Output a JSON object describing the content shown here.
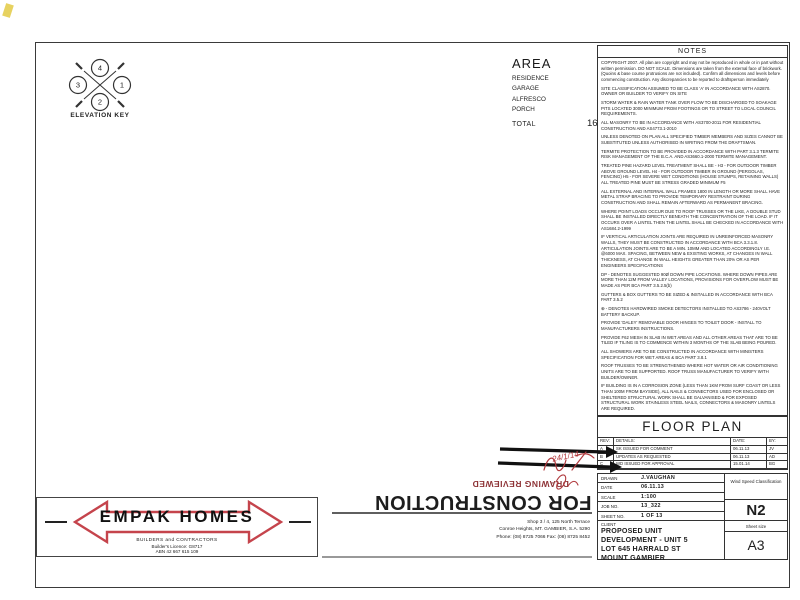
{
  "palette": {
    "ink": "#1f1f1f",
    "wall": "#161616",
    "red_logo": "#c5444c",
    "red_stamp": "#8e3437",
    "tile": "#c9c9c9"
  },
  "elevation_key": {
    "label": "ELEVATION KEY",
    "top": "4",
    "left": "3",
    "right": "1",
    "bottom": "2"
  },
  "area_table": {
    "title": "AREA",
    "rows": [
      [
        "RESIDENCE",
        "130.46"
      ],
      [
        "GARAGE",
        "25.20"
      ],
      [
        "ALFRESCO",
        "9.32"
      ],
      [
        "PORCH",
        "1.39"
      ]
    ],
    "total_label": "TOTAL",
    "total_value": "166.37"
  },
  "notes": {
    "title": "NOTES",
    "paragraphs": [
      "COPYRIGHT 2007. All plan are copyright and may not be reproduced in whole or in part without written permission. DO NOT SCALE. Dimensions are taken from the external face of brickwork. (Quoins & base course protrusions are not included). Confirm all dimensions and levels before commencing construction. Any discrepancies to be reported to draftsperson immediately",
      "SITE CLASSIFICATION ASSUMED TO BE CLASS 'A' IN ACCORDANCE WITH AS2870. OWNER OR BUILDER TO VERIFY ON SITE",
      "STORM WATER & RAIN WATER TANK OVER FLOW TO BE DISCHARGED TO SOAKAGE PITS LOCATED 3000 MINIMUM FROM FOOTINGS OR TO STREET TO LOCAL COUNCIL REQUIREMENTS.",
      "ALL MASONRY TO BE IN ACCORDANCE WITH AS3700-2011 FOR RESIDENTIAL CONSTRUCTION AND AS4773.1-2010",
      "UNLESS DENOTED ON PLAN ALL SPECIFIED TIMBER MEMBERS AND SIZES CANNOT BE SUBSTITUTED UNLESS AUTHORISED IN WRITING FROM THE DRAFTSMAN.",
      "TERMITE PROTECTION TO BE PROVIDED IN ACCORDANCE WITH PART 3.1.3 TERMITE RISK MANAGEMENT OF THE B.C.A. AND AS3660.1-2000 TERMITE MANAGEMENT.",
      "TREATED PINE HAZARD LEVEL TREATMENT SHALL BE -  H3 - FOR OUTDOOR TIMBER ABOVE GROUND LEVEL  H4 - FOR OUTDOOR TIMBER IN GROUND (PERGOLAS, FENCING)  H5 - FOR SEVERE WET CONDITIONS (HOUSE STUMPS, RETAINING WALLS)  ALL TREATED PINE MUST BE STRESS GRADED MINIMUM F5",
      "ALL EXTERNAL AND INTERNAL WALL FRAMES 1800 IN LENGTH OR MORE SHALL HAVE METAL STRAP BRACING TO PROVIDE TEMPORARY RESTRAINT DURING CONSTRUCTION AND SHALL REMAIN AFTERWARD AS PERMANENT BRACING.",
      "WHERE POINT LOADS OCCUR DUE TO ROOF TRUSSES OR THE LIKE, A DOUBLE STUD SHALL BE INSTALLED DIRECTLY BENEATH THE CONCENTRATION OF THE LOAD. IF IT OCCURS OVER A LINTEL THEN THE LINTEL SHALL BE CHECKED IN ACCORDANCE WITH AS1684.2-1999",
      "IF VERTICAL ARTICULATION JOINTS ARE REQUIRED IN UNREINFORCED MASONRY WALLS, THEY MUST BE CONSTRUCTED IN ACCORDANCE WITH BCA 3.3.1.8. ARTICULATION JOINTS ARE TO BE A MIN. 10MM AND LOCATED ACCORDINGLY I.E. @6000 MAX. SPACING, BETWEEN NEW & EXISTING WORKS, AT CHANGES IN WALL THICKNESS, AT CHANGE IN WALL HEIGHTS GREATER THAN 20% OR AS PER ENGINEERS SPECIFICATIONS",
      "DP - DENOTES SUGGESTED 90Ø DOWN PIPE LOCATIONS. WHERE DOWN PIPES ARE MORE THAN 12M FROM VALLEY LOCATIONS, PROVISIONS FOR OVERFLOW MUST BE MADE AS PER BCA PART 3.5.2.5(b)",
      "GUTTERS & BOX GUTTERS TO BE SIZED & INSTALLED IN ACCORDANCE WITH BCA PART 3.5.2",
      "⊕ - DENOTES HARDWIRED SMOKE DETECTORS INSTALLED TO AS3786 - 240VOLT BATTERY BACKUP.",
      "PROVIDE 'DALEY' REMOVABLE DOOR HINGES TO TOILET DOOR - INSTALL TO MANUFACTURERS INSTRUCTIONS.",
      "PROVIDE F62 MESH IN SLAB IN WET AREAS AND ALL OTHER AREAS THAT ARE TO BE TILED IF TILING IS TO COMMENCE WITHIN 3 MONTHS OF THE SLAB BEING POURED.",
      "ALL SHOWERS ARE TO BE CONSTRUCTED IN ACCORDANCE WITH MINISTERS SPECIFICATION FOR WET AREAS & BCA PART 3.8.1",
      "ROOF TRUSSES TO BE STRENGTHENED WHERE HOT WATER OR AIR CONDITIONING UNITS ARE TO BE SUPPORTED. ROOF TRUSS MANUFACTURER TO VERIFY WITH BUILDER/OWNER.",
      "IF BUILDING IS IN A CORROSION ZONE (LESS THAN 1KM FROM SURF COAST OR LESS THAN 100M FROM BAYSIDE), ALL NAILS & CONNECTORS USED FOR ENCLOSED OR SHELTERED STRUCTURAL WORK SHALL BE GALVANISED & FOR EXPOSED STRUCTURAL WORK STAINLESS STEEL NAILS, CONNECTORS & MASONRY LINTELS ARE REQUIRED.",
      "DG - DENOTES WINDOWS & OR DOORS THAT ARE REQUIRED TO BE DOUBLE GLAZED (OR SIMILAR SYSTEM WITH EQUIVALENT VALUES OF U-VALUE 3.73 & SHGC 0.66) TO COMPLY WITH 6 STAR 'FIRST RATE' ENERGY REPORT"
    ]
  },
  "floor_plan_title": "FLOOR PLAN",
  "revision_table": {
    "headers": [
      "REV:",
      "DETAILS:",
      "DATE:",
      "BY:"
    ],
    "rows": [
      [
        "A",
        "SK ISSUED FOR COMMENT",
        "06.11.13",
        "JV"
      ],
      [
        "B",
        "UPDATES AS REQUESTED",
        "06.11.13",
        "AD"
      ],
      [
        "C",
        "WD ISSUED FOR APPROVAL",
        "15.01.14",
        "BG"
      ],
      [
        "",
        "",
        "",
        ""
      ]
    ]
  },
  "title_block": {
    "drawn_label": "DRAWN",
    "drawn": "J.VAUGHAN",
    "date_label": "DATE",
    "date": "06.11.13",
    "scale_label": "SCALE",
    "scale": "1:100",
    "job_label": "JOB NO.",
    "job": "13_322",
    "sheet_label": "SHEET NO.",
    "sheet": "1    OF    13",
    "wind_label": "Wind Speed Classification",
    "wind": "N2",
    "client_label": "CLIENT",
    "client_lines": [
      "PROPOSED UNIT",
      "DEVELOPMENT - UNIT 5",
      "LOT 645 HARRALD ST",
      "MOUNT GAMBIER"
    ],
    "sheet_size_label": "Sheet size",
    "sheet_size": "A3"
  },
  "logo": {
    "name": "EMPAK  HOMES",
    "sub1": "BUILDERS and CONTRACTORS",
    "sub2": "Builder's Licence:  G8717",
    "sub3": "ABN 42 667 615 109"
  },
  "address_lines": [
    "Shop 3 / 4, 125 North Terrace",
    "Conroe Heights, MT. GAMBIER, S.A. 5290",
    "Phone: (08) 8725 7066    Fax: (08) 8725 8452"
  ],
  "stamps": {
    "construction": "FOR CONSTRUCTION",
    "reviewed": "DRAWING REVIEWED",
    "signature_date": "24/1/14"
  },
  "plan": {
    "eaves": {
      "x": 160,
      "y": 178,
      "w": 380,
      "h": 270
    },
    "rooms": [
      {
        "name": "ALFRESCO",
        "x": 233,
        "y": 192,
        "w": 107,
        "h": 64,
        "style": "dashed",
        "lx": 287,
        "ly": 218,
        "fs": 8,
        "diag": "d1"
      },
      {
        "name": "LOUNGE",
        "x": 378,
        "y": 192,
        "w": 86,
        "h": 64,
        "style": "wall",
        "lx": 421,
        "ly": 214,
        "fs": 8,
        "diag": "d1"
      },
      {
        "name": "MEALS",
        "x": 190,
        "y": 256,
        "w": 140,
        "h": 78,
        "style": "wall",
        "tiled": true,
        "lx": 256,
        "ly": 290,
        "fs": 9
      },
      {
        "name": "FAMILY",
        "x": 330,
        "y": 256,
        "w": 170,
        "h": 84,
        "style": "wall",
        "lx": 424,
        "ly": 304,
        "fs": 9.5,
        "sub": "FFL 53.650",
        "diag": "x"
      },
      {
        "name": "KITCHEN",
        "x": 205,
        "y": 334,
        "w": 76,
        "h": 46,
        "style": "wall",
        "tiled": true,
        "lx": 240,
        "ly": 361,
        "fs": 7
      },
      {
        "name": "BED 2",
        "x": 107,
        "y": 262,
        "w": 100,
        "h": 98,
        "style": "wall",
        "lx": 150,
        "ly": 313,
        "fs": 8
      },
      {
        "name": "BED 3",
        "x": 107,
        "y": 360,
        "w": 125,
        "h": 68,
        "style": "wall",
        "lx": 162,
        "ly": 395,
        "fs": 8,
        "diag": "d1"
      },
      {
        "name": "L'DRY",
        "x": 234,
        "y": 360,
        "w": 46,
        "h": 68,
        "style": "wall",
        "tiled": true,
        "lx": 258,
        "ly": 392,
        "fs": 6.5
      },
      {
        "name": "WC",
        "x": 282,
        "y": 388,
        "w": 26,
        "h": 40,
        "style": "wall",
        "tiled": true,
        "lx": 295,
        "ly": 402,
        "fs": 5
      },
      {
        "name": "BATH",
        "x": 310,
        "y": 360,
        "w": 54,
        "h": 68,
        "style": "wall",
        "tiled": true,
        "lx": 337,
        "ly": 390,
        "fs": 7.5
      },
      {
        "name": "BED 1",
        "x": 330,
        "y": 340,
        "w": 82,
        "h": 88,
        "style": "wall",
        "lx": 368,
        "ly": 386,
        "fs": 8
      },
      {
        "name": "ENTRY",
        "x": 396,
        "y": 310,
        "w": 48,
        "h": 34,
        "style": "wall",
        "lx": 420,
        "ly": 328,
        "fs": 6.5
      },
      {
        "name": "GARAGE",
        "x": 420,
        "y": 314,
        "w": 85,
        "h": 114,
        "style": "wall",
        "lx": 461,
        "ly": 347,
        "fs": 10,
        "diag": "x"
      }
    ],
    "fixtures": [
      {
        "type": "rect",
        "x": 296,
        "y": 292,
        "w": 36,
        "h": 76
      },
      {
        "type": "circle",
        "cx": 306,
        "cy": 318,
        "r": 2.2
      },
      {
        "type": "circle",
        "cx": 316,
        "cy": 318,
        "r": 2.2
      },
      {
        "type": "circle",
        "cx": 306,
        "cy": 330,
        "r": 2.2
      },
      {
        "type": "circle",
        "cx": 316,
        "cy": 330,
        "r": 2.2
      },
      {
        "type": "rect",
        "x": 212,
        "y": 340,
        "w": 16,
        "h": 9
      },
      {
        "type": "rect",
        "x": 282,
        "y": 334,
        "w": 22,
        "h": 24
      },
      {
        "type": "rrect",
        "x": 316,
        "y": 400,
        "w": 44,
        "h": 22
      },
      {
        "type": "ellipse",
        "cx": 295,
        "cy": 404,
        "rx": 4,
        "ry": 6
      },
      {
        "type": "rect",
        "x": 290,
        "y": 394,
        "w": 10,
        "h": 5
      },
      {
        "type": "circle",
        "cx": 257,
        "cy": 396,
        "r": 5.5
      },
      {
        "type": "rect",
        "x": 146,
        "y": 270,
        "w": 36,
        "h": 16,
        "dash": true
      },
      {
        "type": "rect",
        "x": 233,
        "y": 192,
        "w": 6,
        "h": 6
      },
      {
        "type": "rect",
        "x": 334,
        "y": 192,
        "w": 6,
        "h": 6
      },
      {
        "type": "path",
        "d": "M420 310 A16 16 0 0 1 404 326"
      },
      {
        "type": "path",
        "d": "M330 352 A14 14 0 0 1 344 366"
      },
      {
        "type": "line",
        "x1": 432,
        "y1": 428,
        "x2": 492,
        "y2": 428,
        "stroke": "#ffffff",
        "w": 5
      },
      {
        "type": "line",
        "x1": 432,
        "y1": 428,
        "x2": 492,
        "y2": 428,
        "stroke": "#888888",
        "w": 1
      },
      {
        "type": "smoke",
        "cx": 308,
        "cy": 316
      },
      {
        "type": "smoke",
        "cx": 246,
        "cy": 350
      }
    ],
    "section_lines": [
      {
        "x1": 60,
        "y1": 244,
        "x2": 562,
        "y2": 244
      },
      {
        "x1": 330,
        "y1": 394,
        "x2": 578,
        "y2": 394
      }
    ],
    "markers": [
      {
        "letter": "A",
        "num": "4",
        "x": 103,
        "y": 244
      },
      {
        "letter": "A",
        "num": "4",
        "x": 572,
        "y": 244
      },
      {
        "letter": "B",
        "num": "4",
        "x": 299,
        "y": 262
      },
      {
        "letter": "C",
        "num": "5",
        "x": 398,
        "y": 364
      },
      {
        "letter": "D",
        "num": "5",
        "x": 378,
        "y": 394
      },
      {
        "letter": "D",
        "num": "5",
        "x": 586,
        "y": 394
      }
    ],
    "dim_chains": [
      {
        "dir": "h",
        "pos": 96,
        "from": 105,
        "to": 505,
        "segs": [
          "16850"
        ],
        "fs": 6
      },
      {
        "dir": "h",
        "pos": 114,
        "from": 105,
        "to": 505,
        "segs": [
          "250",
          "3880",
          "90",
          "7200",
          "250",
          "1080",
          "250"
        ],
        "fs": 4.6
      },
      {
        "dir": "h",
        "pos": 132,
        "from": 105,
        "to": 505,
        "segs": [
          "3970",
          "250",
          "7200",
          "250",
          "900",
          "280"
        ],
        "fs": 4.6
      },
      {
        "dir": "h",
        "pos": 150,
        "from": 105,
        "to": 505,
        "segs": [
          "3970",
          "3900",
          "250",
          "4400",
          "380"
        ],
        "fs": 4.6
      },
      {
        "dir": "h",
        "pos": 168,
        "from": 105,
        "to": 505,
        "segs": [
          "3970",
          "3900",
          "4900",
          "380"
        ],
        "fs": 4.6
      },
      {
        "dir": "h",
        "pos": 444,
        "from": 105,
        "to": 500,
        "segs": [
          "250",
          "3300",
          "90",
          "1700",
          "90",
          "1800",
          "90",
          "1800",
          "90",
          "3900",
          "90",
          "3600",
          "250"
        ],
        "fs": 3.8
      },
      {
        "dir": "h",
        "pos": 458,
        "from": 105,
        "to": 500,
        "segs": [
          "250",
          "3900",
          "90",
          "4680",
          "90",
          "3900",
          "90",
          "3600",
          "250"
        ],
        "fs": 4.2
      },
      {
        "dir": "h",
        "pos": 472,
        "from": 105,
        "to": 500,
        "segs": [
          "250",
          "3880",
          "90",
          "7200",
          "90",
          "1400",
          "90",
          "3600",
          "250"
        ],
        "fs": 4.2
      },
      {
        "dir": "h",
        "pos": 486,
        "from": 105,
        "to": 500,
        "segs": [
          "16850"
        ],
        "fs": 6
      },
      {
        "dir": "v",
        "pos": 50,
        "from": 185,
        "to": 445,
        "segs": [
          "13080"
        ],
        "fs": 6
      },
      {
        "dir": "v",
        "pos": 66,
        "from": 185,
        "to": 445,
        "segs": [
          "2690",
          "2110",
          "930",
          "7480"
        ],
        "fs": 4.6
      },
      {
        "dir": "v",
        "pos": 82,
        "from": 185,
        "to": 445,
        "segs": [
          "250",
          "1000",
          "1520",
          "2510",
          "3600",
          "250"
        ],
        "fs": 4.6
      },
      {
        "dir": "v",
        "pos": 524,
        "from": 185,
        "to": 445,
        "segs": [
          "2453",
          "1937",
          "1400",
          "3770",
          "1080"
        ],
        "fs": 4.6
      },
      {
        "dir": "v",
        "pos": 542,
        "from": 185,
        "to": 445,
        "segs": [
          "250",
          "1820",
          "6600",
          "3800",
          "250"
        ],
        "fs": 4.6
      },
      {
        "dir": "v",
        "pos": 560,
        "from": 185,
        "to": 445,
        "segs": [
          "250",
          "6000",
          "3600",
          "250"
        ],
        "fs": 4.6
      },
      {
        "dir": "v",
        "pos": 576,
        "from": 185,
        "to": 445,
        "segs": [
          "13080"
        ],
        "fs": 6
      }
    ],
    "texts": [
      {
        "t": "3460",
        "x": 287,
        "y": 203,
        "s": 5
      },
      {
        "t": "3600",
        "x": 258,
        "y": 266,
        "s": 5
      },
      {
        "t": "2700",
        "x": 424,
        "y": 250,
        "s": 5
      },
      {
        "t": "4057",
        "x": 300,
        "y": 354,
        "s": 4.5
      },
      {
        "t": "2400x2700H RD",
        "x": 452,
        "y": 302,
        "s": 4
      },
      {
        "t": "0906SH",
        "x": 240,
        "y": 433,
        "s": 4.3
      },
      {
        "t": "0903SW",
        "x": 288,
        "y": 433,
        "s": 4.3
      },
      {
        "t": "0914SSW",
        "x": 334,
        "y": 433,
        "s": 4.3
      },
      {
        "t": "1214SSW",
        "x": 386,
        "y": 433,
        "s": 4.3
      },
      {
        "t": "1214SSW",
        "x": 102,
        "y": 336,
        "s": 4.3,
        "r": -90
      },
      {
        "t": "0914SSW-240HD",
        "x": 510,
        "y": 372,
        "s": 4,
        "r": -90
      },
      {
        "t": "600 EAVES",
        "x": 520,
        "y": 450,
        "s": 5
      },
      {
        "t": "600 EAVES",
        "x": 152,
        "y": 468,
        "s": 4.8,
        "r": -90
      },
      {
        "t": "R/W",
        "x": 163,
        "y": 276,
        "s": 3.6
      },
      {
        "t": "WATER TANK",
        "x": 163,
        "y": 281,
        "s": 3.6
      },
      {
        "t": "ROBE",
        "x": 200,
        "y": 330,
        "s": 4,
        "r": -90
      },
      {
        "t": "820",
        "x": 287,
        "y": 372,
        "s": 3.5,
        "r": -90
      },
      {
        "t": "pantry",
        "x": 293,
        "y": 347,
        "s": 3.8
      },
      {
        "t": "4525 bath",
        "x": 338,
        "y": 396,
        "s": 3.8
      },
      {
        "t": "DP",
        "x": 112,
        "y": 434,
        "s": 4
      },
      {
        "t": "DP",
        "x": 497,
        "y": 420,
        "s": 4
      }
    ]
  }
}
